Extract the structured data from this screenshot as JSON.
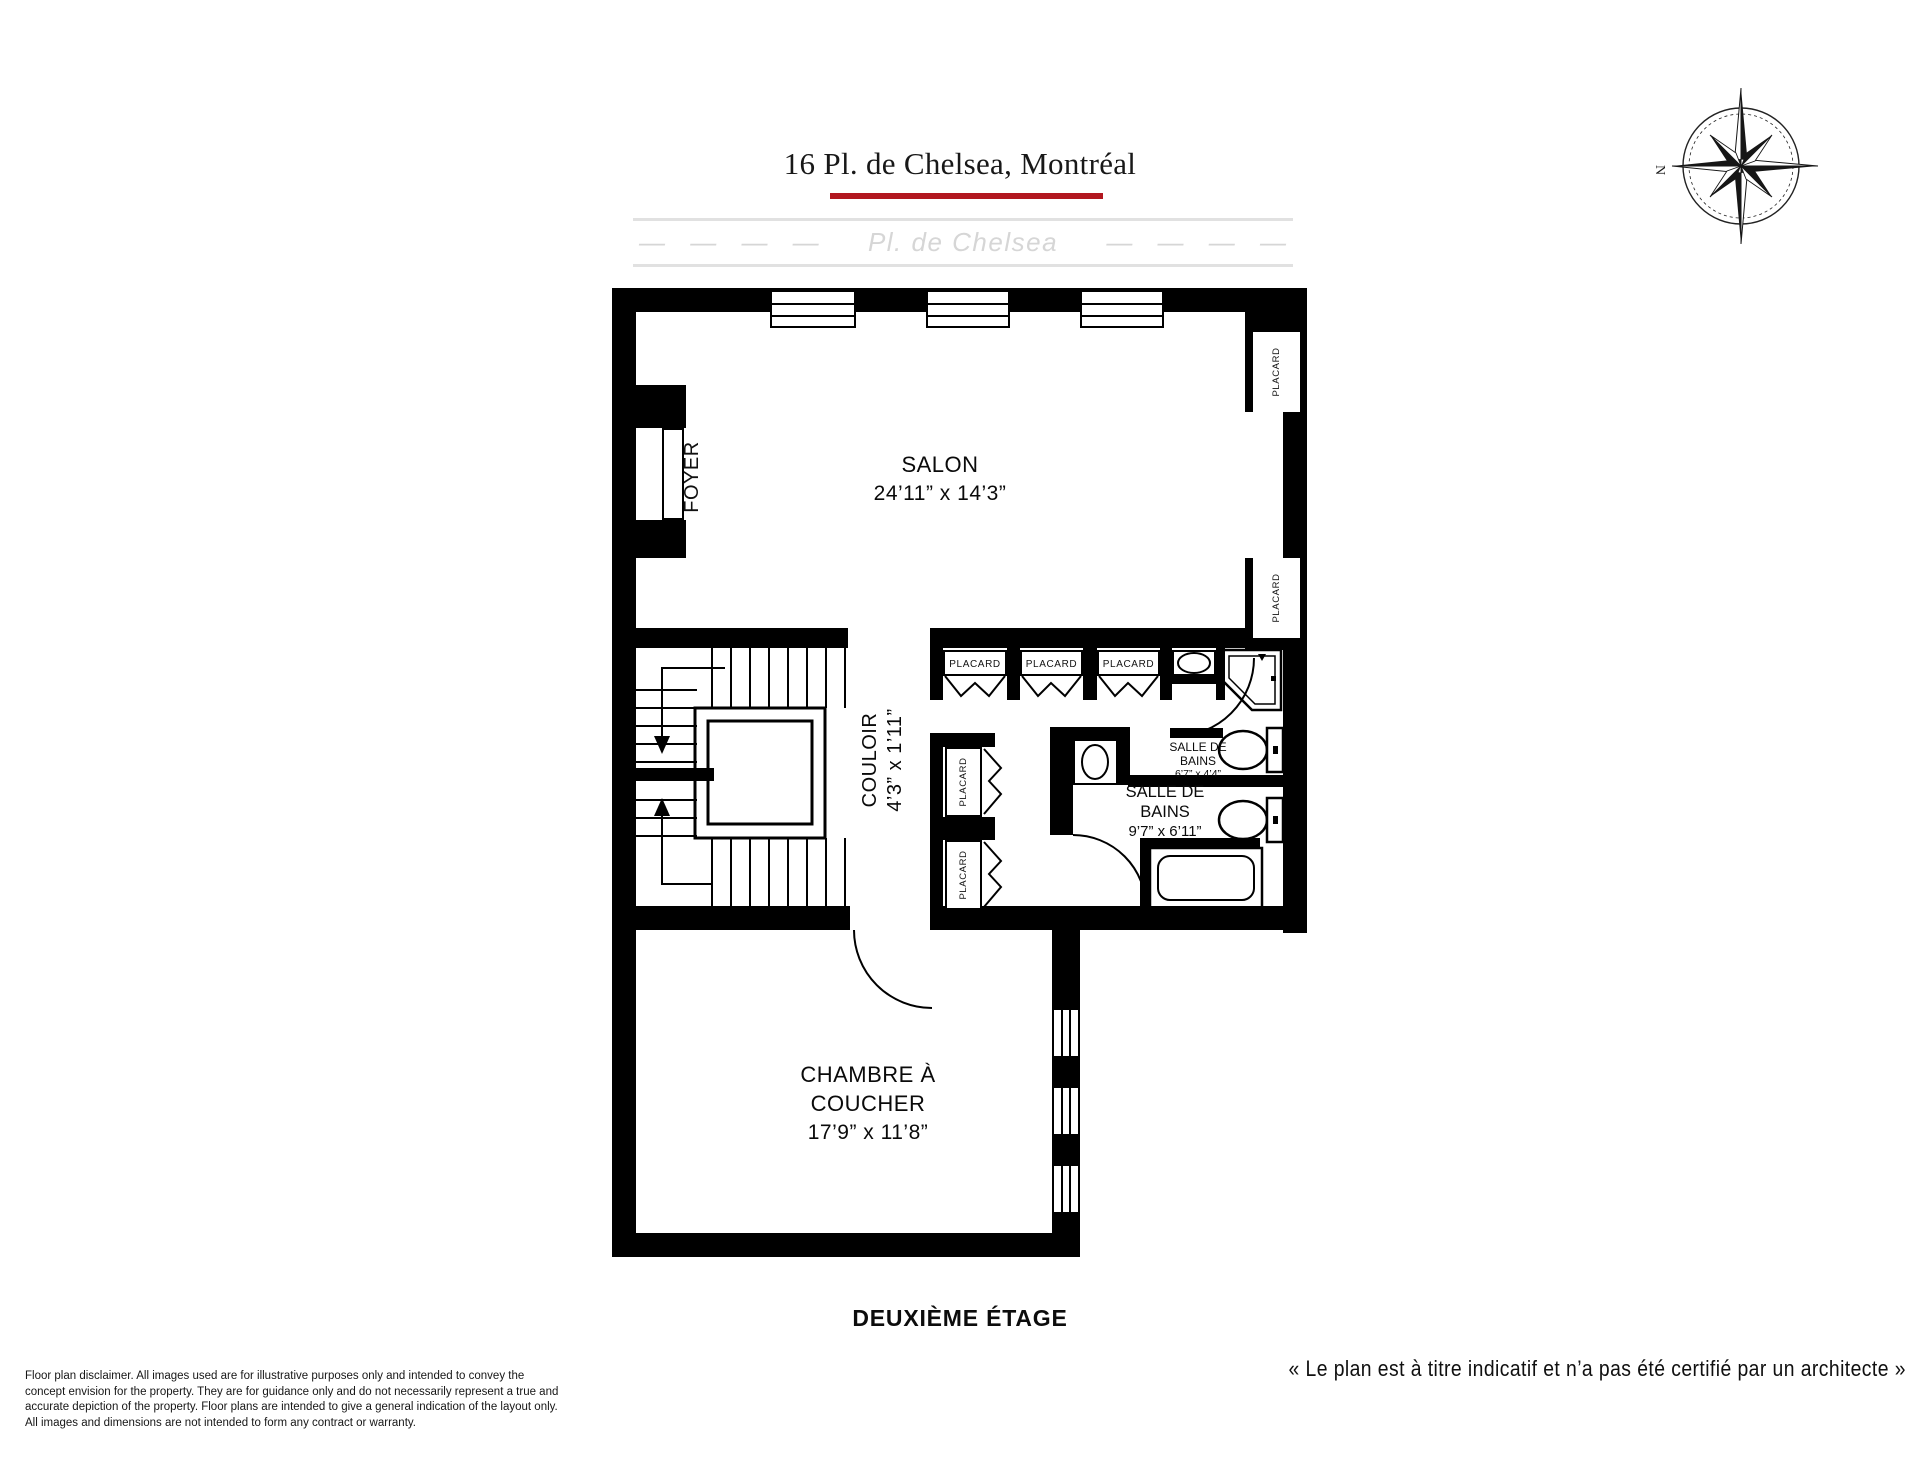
{
  "header": {
    "title": "16 Pl. de Chelsea, Montréal"
  },
  "street": {
    "name": "Pl. de Chelsea",
    "dashes": "—  —  —  —"
  },
  "compass": {
    "north": "N"
  },
  "rooms": {
    "salon": {
      "name": "SALON",
      "dims": "24’11” x 14’3”"
    },
    "foyer": {
      "name": "FOYER"
    },
    "couloir": {
      "name": "COULOIR",
      "dims": "4’3” x 1’11”"
    },
    "chambre": {
      "name1": "CHAMBRE À",
      "name2": "COUCHER",
      "dims": "17’9” x 11’8”"
    },
    "bain1": {
      "name1": "SALLE DE",
      "name2": "BAINS",
      "dims": "6’7” x 4’4”"
    },
    "bain2": {
      "name1": "SALLE DE",
      "name2": "BAINS",
      "dims": "9’7” x 6’11”"
    }
  },
  "closet_label": "PLACARD",
  "floor_label": "DEUXIÈME ÉTAGE",
  "footer": {
    "architect_note": "« Le plan est à titre indicatif et n’a pas été certifié par un architecte »",
    "disclaimer": {
      "l1": "Floor plan disclaimer. All images used are for illustrative purposes only and intended to convey the",
      "l2": "concept envision for the property. They are for guidance only and do not necessarily represent a true and",
      "l3": "accurate depiction of the property. Floor plans are intended to give a general indication of the layout only.",
      "l4": "All images and dimensions are not intended to form any contract or warranty."
    }
  },
  "colors": {
    "accent_red": "#b2171f",
    "wall": "#000000",
    "street_gray": "#d6d6d6"
  }
}
